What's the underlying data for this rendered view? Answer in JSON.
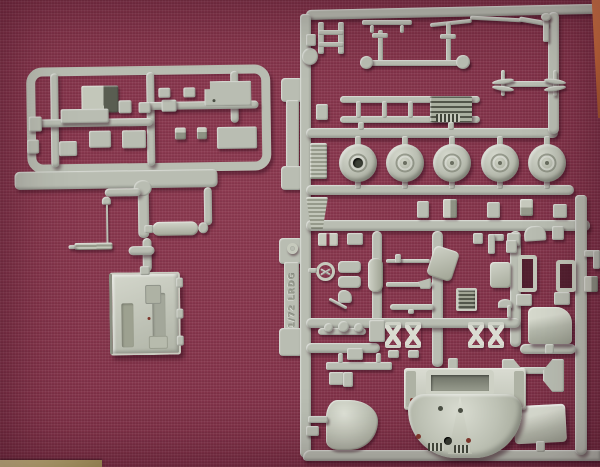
{
  "scene": {
    "type": "photograph",
    "subject": "Two light grey injection-moulded sprues of a 1/72 scale LRDG model truck kit lying on dark burgundy woven fabric",
    "colors": {
      "fabric": "#7d2f46",
      "sprue": "#b9bdb2",
      "sprue_dark": "#878b7d",
      "sprue_light": "#dcdfd6",
      "wood_edge": "#c96f38",
      "table_strip": "#c6b57c",
      "dark_detail": "#4a4e43",
      "red_detail": "#7c352b"
    }
  },
  "sprue_marking": {
    "scale": "1/72",
    "kit": "LRDG",
    "full": "1/72 LRDG"
  },
  "left_sprue": {
    "name": "flat parts sprue",
    "contents": [
      "cargo bed panels",
      "stowage boxes",
      "radio antenna",
      "fuel tank",
      "cab floor tray"
    ]
  },
  "right_sprue": {
    "name": "main parts sprue",
    "wheel_count": 5,
    "contents": [
      "chassis ladder frame",
      "engine block",
      "axles",
      "tow rod",
      "road wheels",
      "steering wheel",
      "leaf springs",
      "rifles",
      "radiator grille",
      "seats",
      "windscreen frames",
      "fender",
      "cab bonnet with grille",
      "nose cone",
      "rear panel"
    ]
  }
}
